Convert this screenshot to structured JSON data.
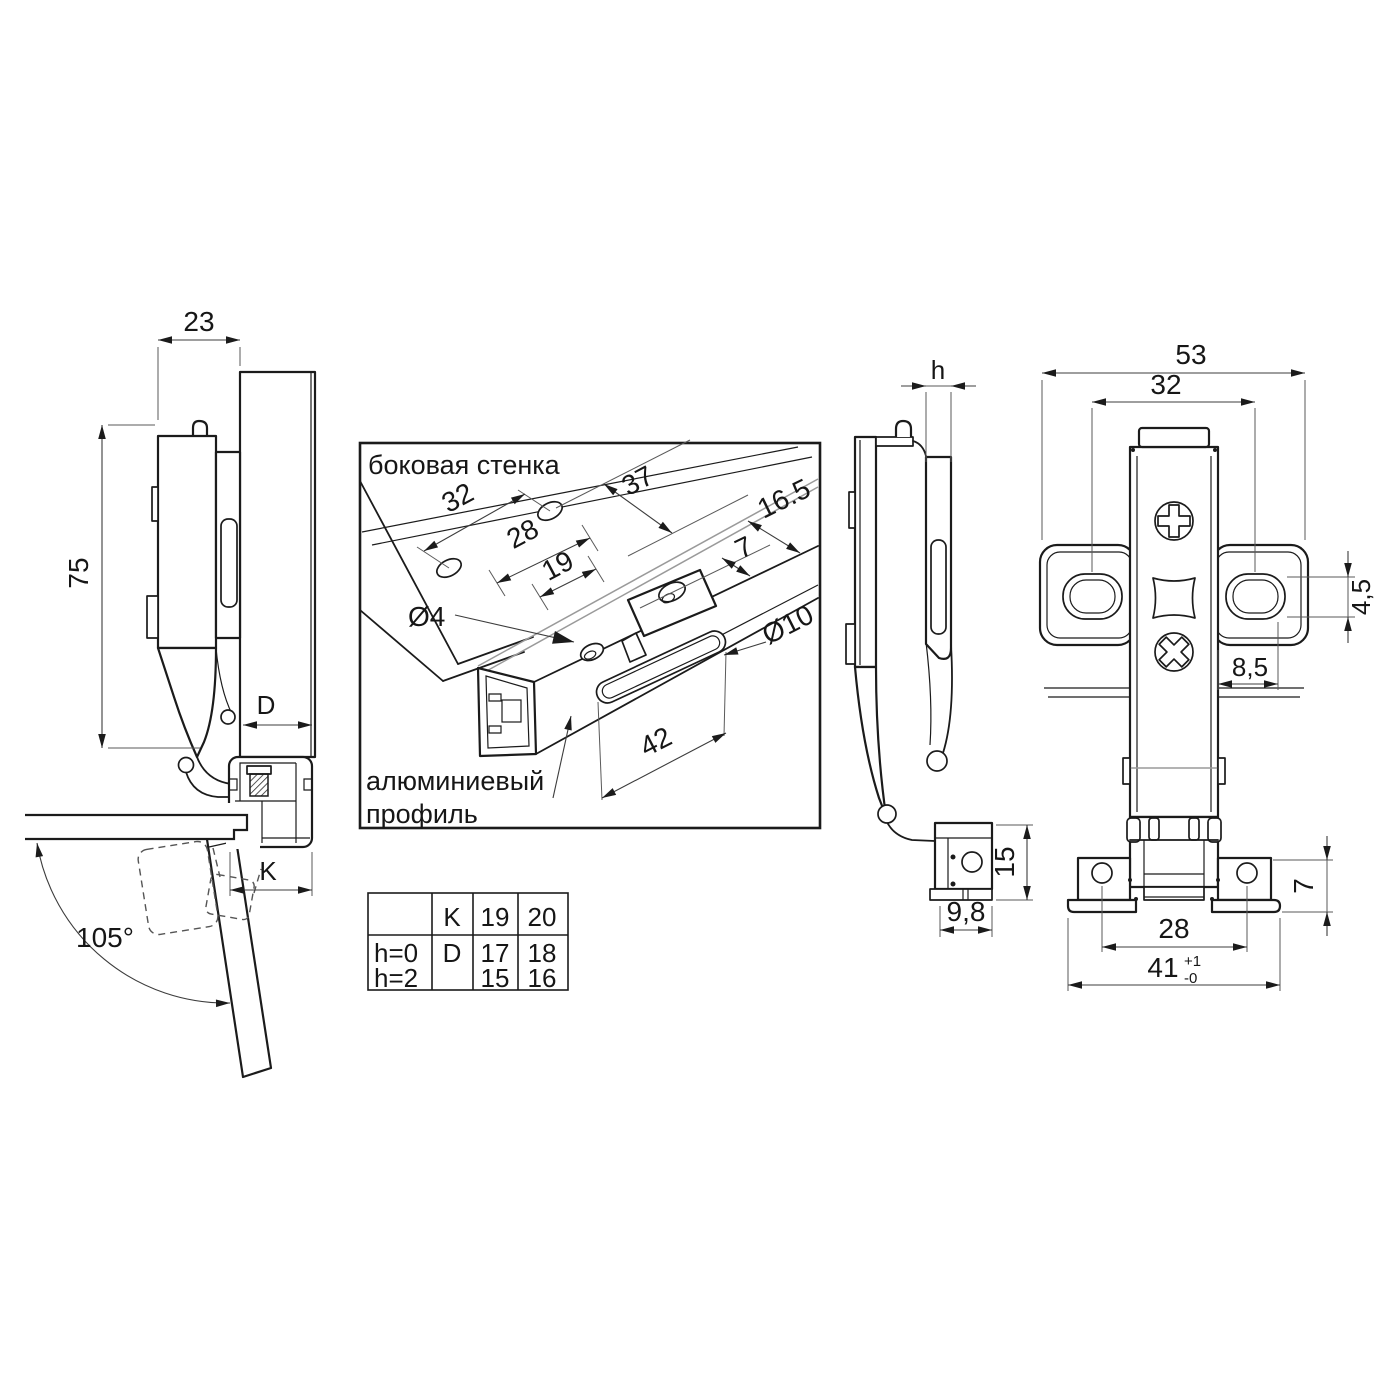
{
  "drawing": {
    "left_view": {
      "dim_width": "23",
      "dim_height": "75",
      "dim_d": "D",
      "dim_k": "K",
      "angle": "105°"
    },
    "inset": {
      "title": "боковая стенка",
      "callout_line1": "алюминиевый",
      "callout_line2": "профиль",
      "dim_32": "32",
      "dim_37": "37",
      "dim_28": "28",
      "dim_19": "19",
      "dim_16_5": "16.5",
      "dim_7": "7",
      "dia_4": "Ø4",
      "dia_10": "Ø10",
      "dim_42": "42"
    },
    "side_view": {
      "dim_h": "h",
      "dim_15": "15",
      "dim_9_8": "9,8"
    },
    "front_view": {
      "dim_53": "53",
      "dim_32": "32",
      "dim_4_5": "4,5",
      "dim_8_5": "8,5",
      "dim_28": "28",
      "dim_7": "7",
      "dim_41": "41",
      "dim_41_plus": "+1",
      "dim_41_minus": "-0"
    },
    "table": {
      "rows": [
        [
          "",
          "K",
          "19",
          "20"
        ],
        [
          "h=0",
          "D",
          "17",
          "18"
        ],
        [
          "h=2",
          "",
          "15",
          "16"
        ]
      ]
    }
  }
}
